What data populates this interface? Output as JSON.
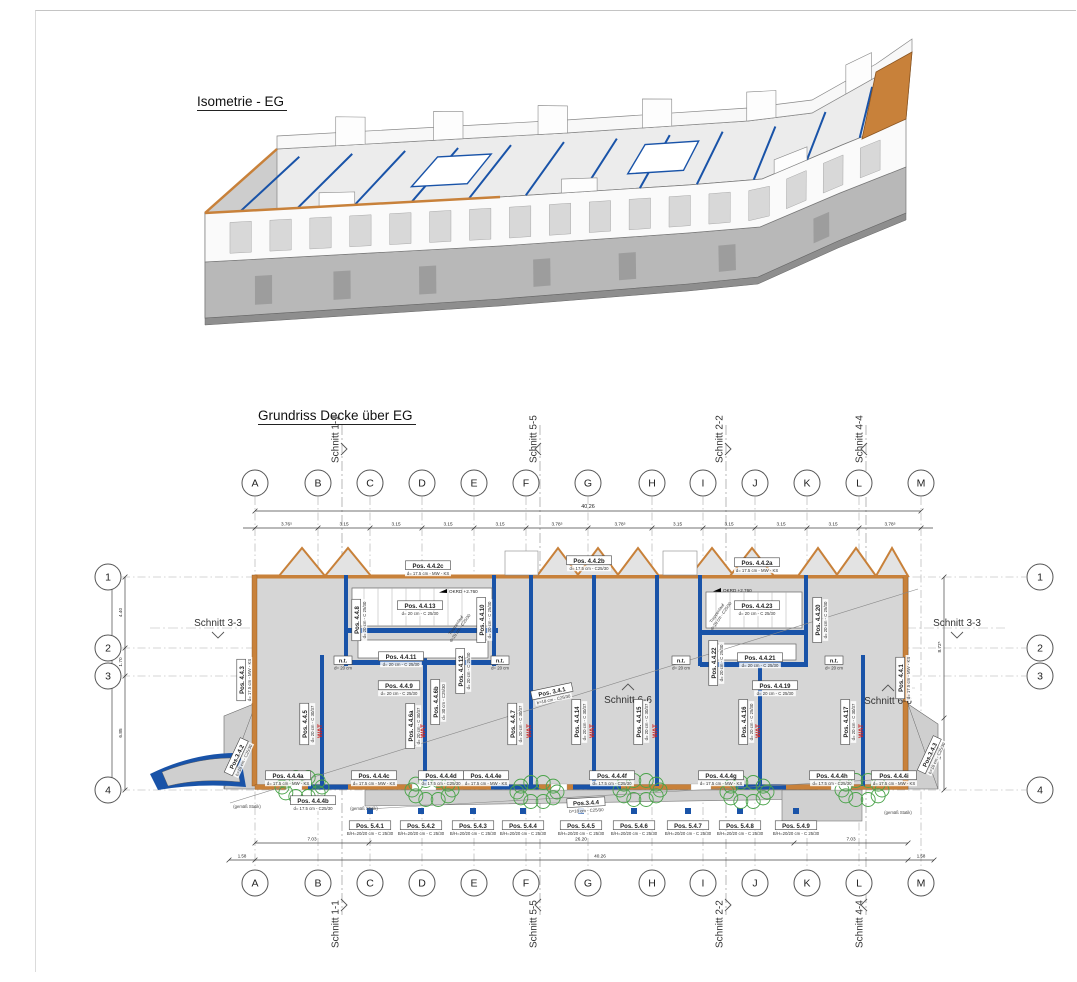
{
  "sheet": {
    "iso_title": "Isometrie - EG",
    "plan_title": "Grundriss Decke über EG"
  },
  "colors": {
    "wall_blue": "#1953a8",
    "masonry_orange": "#c8813a",
    "slab_gray": "#d6d6d6",
    "revision_green": "#4aa34a",
    "wat_red": "#cc2222"
  },
  "grid": {
    "letters": [
      "A",
      "B",
      "C",
      "D",
      "E",
      "F",
      "G",
      "H",
      "I",
      "J",
      "K",
      "L",
      "M"
    ],
    "letter_x": [
      255,
      318,
      370,
      422,
      474,
      526,
      588,
      652,
      703,
      755,
      807,
      859,
      921
    ],
    "rows": [
      "1",
      "2",
      "3",
      "4"
    ],
    "row_y": [
      577,
      648,
      676,
      790
    ]
  },
  "dimensions": {
    "top_total": "40.26",
    "top_segments": [
      "3.76⁵",
      "3.15",
      "3.15",
      "3.15",
      "3.15",
      "3.78⁵",
      "3.78⁵",
      "3.15",
      "3.15",
      "3.15",
      "3.15",
      "3.78⁵"
    ],
    "left_segments": [
      "4.40",
      "1.70",
      "6.85"
    ],
    "left_total": "12.95",
    "right_segments": [
      "8.72⁵",
      "4.22⁵"
    ],
    "bottom_segments": [
      "7.03",
      "26.20",
      "7.03"
    ],
    "bottom_total": "40.26",
    "bottom_left_offset": "1.58",
    "bottom_right_offset": "1.58"
  },
  "sections": {
    "vertical": [
      {
        "label": "Schnitt 1-1",
        "x": 342,
        "arrow": ">"
      },
      {
        "label": "Schnitt 5-5",
        "x": 540,
        "arrow": "<"
      },
      {
        "label": "Schnitt 2-2",
        "x": 726,
        "arrow": ">"
      },
      {
        "label": "Schnitt 4-4",
        "x": 866,
        "arrow": "<"
      }
    ],
    "horizontal": [
      {
        "label": "Schnitt 3-3",
        "x": 218,
        "y": 626,
        "chevron": "down"
      },
      {
        "label": "Schnitt 3-3",
        "x": 957,
        "y": 626,
        "chevron": "down"
      },
      {
        "label": "Schnitt 6-6",
        "x": 628,
        "y": 703,
        "chevron": "up"
      },
      {
        "label": "Schnitt 6-6",
        "x": 888,
        "y": 704,
        "chevron": "up"
      }
    ]
  },
  "pos_labels": [
    {
      "text": "Pos. 4.4.2c",
      "sub": "d= 17.5 cm - MW - KS",
      "x": 428,
      "y": 566,
      "rot": 0
    },
    {
      "text": "Pos. 4.4.2b",
      "sub": "d= 17.5 cm - C25/30",
      "x": 589,
      "y": 561,
      "rot": 0
    },
    {
      "text": "Pos. 4.4.2a",
      "sub": "d= 17.5 cm - MW - KS",
      "x": 757,
      "y": 563,
      "rot": 0
    },
    {
      "text": "Pos. 4.4.13",
      "sub": "d= 20 cm - C 25/30",
      "x": 420,
      "y": 606,
      "rot": 0
    },
    {
      "text": "Pos. 4.4.11",
      "sub": "d= 20 cm - C 25/30",
      "x": 401,
      "y": 657,
      "rot": 0
    },
    {
      "text": "Pos. 4.4.9",
      "sub": "d= 20 cm - C 25/30",
      "x": 399,
      "y": 686,
      "rot": 0
    },
    {
      "text": "Pos. 4.4.23",
      "sub": "d= 20 cm - C 25/30",
      "x": 757,
      "y": 606,
      "rot": 0
    },
    {
      "text": "Pos. 4.4.21",
      "sub": "d= 20 cm - C 25/30",
      "x": 760,
      "y": 658,
      "rot": 0
    },
    {
      "text": "Pos. 4.4.19",
      "sub": "d= 20 cm - C 25/30",
      "x": 775,
      "y": 686,
      "rot": 0
    },
    {
      "text": "Pos. 3.4.1",
      "sub": "b=18 cm - C25/30",
      "x": 552,
      "y": 692,
      "rot": -12
    },
    {
      "text": "Pos.3.4.4",
      "sub": "b=18 cm - C25/30",
      "x": 586,
      "y": 803,
      "rot": -3
    },
    {
      "text": "Pos.3.4.2",
      "sub": "b=18 cm - C25/30",
      "x": 237,
      "y": 757,
      "rot": -65
    },
    {
      "text": "Pos.3.4.3",
      "sub": "b=18 cm - C25/30",
      "x": 930,
      "y": 755,
      "rot": -65
    },
    {
      "text": "Pos. 4.4.4a",
      "sub": "d= 17.5 cm - MW - KS",
      "x": 288,
      "y": 776,
      "rot": 0
    },
    {
      "text": "Pos. 4.4.4b",
      "sub": "d= 17.5 cm - C25/30",
      "x": 313,
      "y": 801,
      "rot": 0
    },
    {
      "text": "Pos. 4.4.4c",
      "sub": "d= 17.5 cm - MW - KS",
      "x": 374,
      "y": 776,
      "rot": 0
    },
    {
      "text": "Pos. 4.4.4d",
      "sub": "d= 17.5 cm - C25/30",
      "x": 441,
      "y": 776,
      "rot": 0
    },
    {
      "text": "Pos. 4.4.4e",
      "sub": "d= 17.5 cm - MW - KS",
      "x": 486,
      "y": 776,
      "rot": 0
    },
    {
      "text": "Pos. 4.4.4f",
      "sub": "d= 17.5 cm - C25/30",
      "x": 612,
      "y": 776,
      "rot": 0
    },
    {
      "text": "Pos. 4.4.4g",
      "sub": "d= 17.5 cm - MW - KS",
      "x": 721,
      "y": 776,
      "rot": 0
    },
    {
      "text": "Pos. 4.4.4h",
      "sub": "d= 17.5 cm - C25/30",
      "x": 832,
      "y": 776,
      "rot": 0
    },
    {
      "text": "Pos. 4.4.4i",
      "sub": "d= 17.5 cm - MW - KS",
      "x": 894,
      "y": 776,
      "rot": 0
    },
    {
      "text": "Pos. 4.4.8",
      "sub": "d= 20 cm - C 25/30",
      "x": 357,
      "y": 620,
      "rot": -90
    },
    {
      "text": "Pos. 4.4.10",
      "sub": "d= 20 cm - C 25/30",
      "x": 482,
      "y": 620,
      "rot": -90
    },
    {
      "text": "Pos. 4.4.12",
      "sub": "d= 20 cm - C 25/30",
      "x": 461,
      "y": 671,
      "rot": -90
    },
    {
      "text": "Pos. 4.4.22",
      "sub": "d= 20 cm - C 25/30",
      "x": 714,
      "y": 663,
      "rot": -90
    },
    {
      "text": "Pos. 4.4.20",
      "sub": "d= 20 cm - C 25/30",
      "x": 818,
      "y": 620,
      "rot": -90
    },
    {
      "text": "Pos. 4.4.3",
      "sub": "d= 17.5 cm - MW - KS",
      "x": 242,
      "y": 680,
      "rot": -90
    },
    {
      "text": "Pos. 4.4.5",
      "sub": "d= 20 cm - C 30/37",
      "x": 305,
      "y": 724,
      "rot": -90
    },
    {
      "text": "Pos. 4.4.6a",
      "sub": "d= 20 cm - C 30/37",
      "x": 411,
      "y": 726,
      "rot": -90
    },
    {
      "text": "Pos. 4.4.6b",
      "sub": "d= 30 cm - C25/30",
      "x": 436,
      "y": 702,
      "rot": -90
    },
    {
      "text": "Pos. 4.4.7",
      "sub": "d= 20 cm - C 30/37",
      "x": 513,
      "y": 724,
      "rot": -90
    },
    {
      "text": "Pos. 4.4.14",
      "sub": "d= 20 cm - C 30/37",
      "x": 577,
      "y": 722,
      "rot": -90
    },
    {
      "text": "Pos. 4.4.15",
      "sub": "d= 20 cm - C 30/37",
      "x": 639,
      "y": 722,
      "rot": -90
    },
    {
      "text": "Pos. 4.4.16",
      "sub": "d= 20 cm - C 25/30",
      "x": 744,
      "y": 722,
      "rot": -90
    },
    {
      "text": "Pos. 4.4.17",
      "sub": "d= 20 cm - C 30/37",
      "x": 846,
      "y": 722,
      "rot": -90
    },
    {
      "text": "Pos. 4.4.1",
      "sub": "d= 17.5 cm - MW - KS",
      "x": 901,
      "y": 678,
      "rot": -90
    },
    {
      "text": "Pos. 5.4.1",
      "sub": "B/H=20/20 cm - C 25/30",
      "x": 370,
      "y": 826,
      "rot": 0
    },
    {
      "text": "Pos. 5.4.2",
      "sub": "B/H=20/20 cm - C 25/30",
      "x": 421,
      "y": 826,
      "rot": 0
    },
    {
      "text": "Pos. 5.4.3",
      "sub": "B/H=20/20 cm - C 25/30",
      "x": 473,
      "y": 826,
      "rot": 0
    },
    {
      "text": "Pos. 5.4.4",
      "sub": "B/H=20/20 cm - C 25/30",
      "x": 523,
      "y": 826,
      "rot": 0
    },
    {
      "text": "Pos. 5.4.5",
      "sub": "B/H=20/20 cm - C 25/30",
      "x": 581,
      "y": 826,
      "rot": 0
    },
    {
      "text": "Pos. 5.4.6",
      "sub": "B/H=20/20 cm - C 25/30",
      "x": 634,
      "y": 826,
      "rot": 0
    },
    {
      "text": "Pos. 5.4.7",
      "sub": "B/H=20/20 cm - C 25/30",
      "x": 688,
      "y": 826,
      "rot": 0
    },
    {
      "text": "Pos. 5.4.8",
      "sub": "B/H=20/20 cm - C 25/30",
      "x": 740,
      "y": 826,
      "rot": 0
    },
    {
      "text": "Pos. 5.4.9",
      "sub": "B/H=20/20 cm - C 25/30",
      "x": 796,
      "y": 826,
      "rot": 0
    }
  ],
  "nt_boxes": {
    "label": "n.t.",
    "sub": "d= 20 cm",
    "x": [
      343,
      500,
      681,
      834
    ],
    "y": 661
  },
  "wat": {
    "label": "WAT",
    "x": [
      322,
      425,
      531,
      594,
      657,
      760,
      863
    ],
    "y": 731
  },
  "okrd": {
    "label": "OKRD +2.760",
    "points": [
      [
        450,
        592
      ],
      [
        724,
        591
      ]
    ]
  },
  "stair_notes": {
    "line1": "Treppenlauf",
    "line2": "d=20 cm - C25/30",
    "points": [
      [
        457,
        626
      ],
      [
        718,
        614
      ]
    ]
  },
  "statik_notes": {
    "label": "(gemäß Statik)",
    "points": [
      [
        247,
        808
      ],
      [
        364,
        810
      ],
      [
        898,
        814
      ]
    ]
  },
  "revision_clouds": {
    "points": [
      [
        302,
        787
      ],
      [
        432,
        790
      ],
      [
        537,
        792
      ],
      [
        640,
        790
      ],
      [
        747,
        792
      ],
      [
        862,
        790
      ]
    ]
  }
}
